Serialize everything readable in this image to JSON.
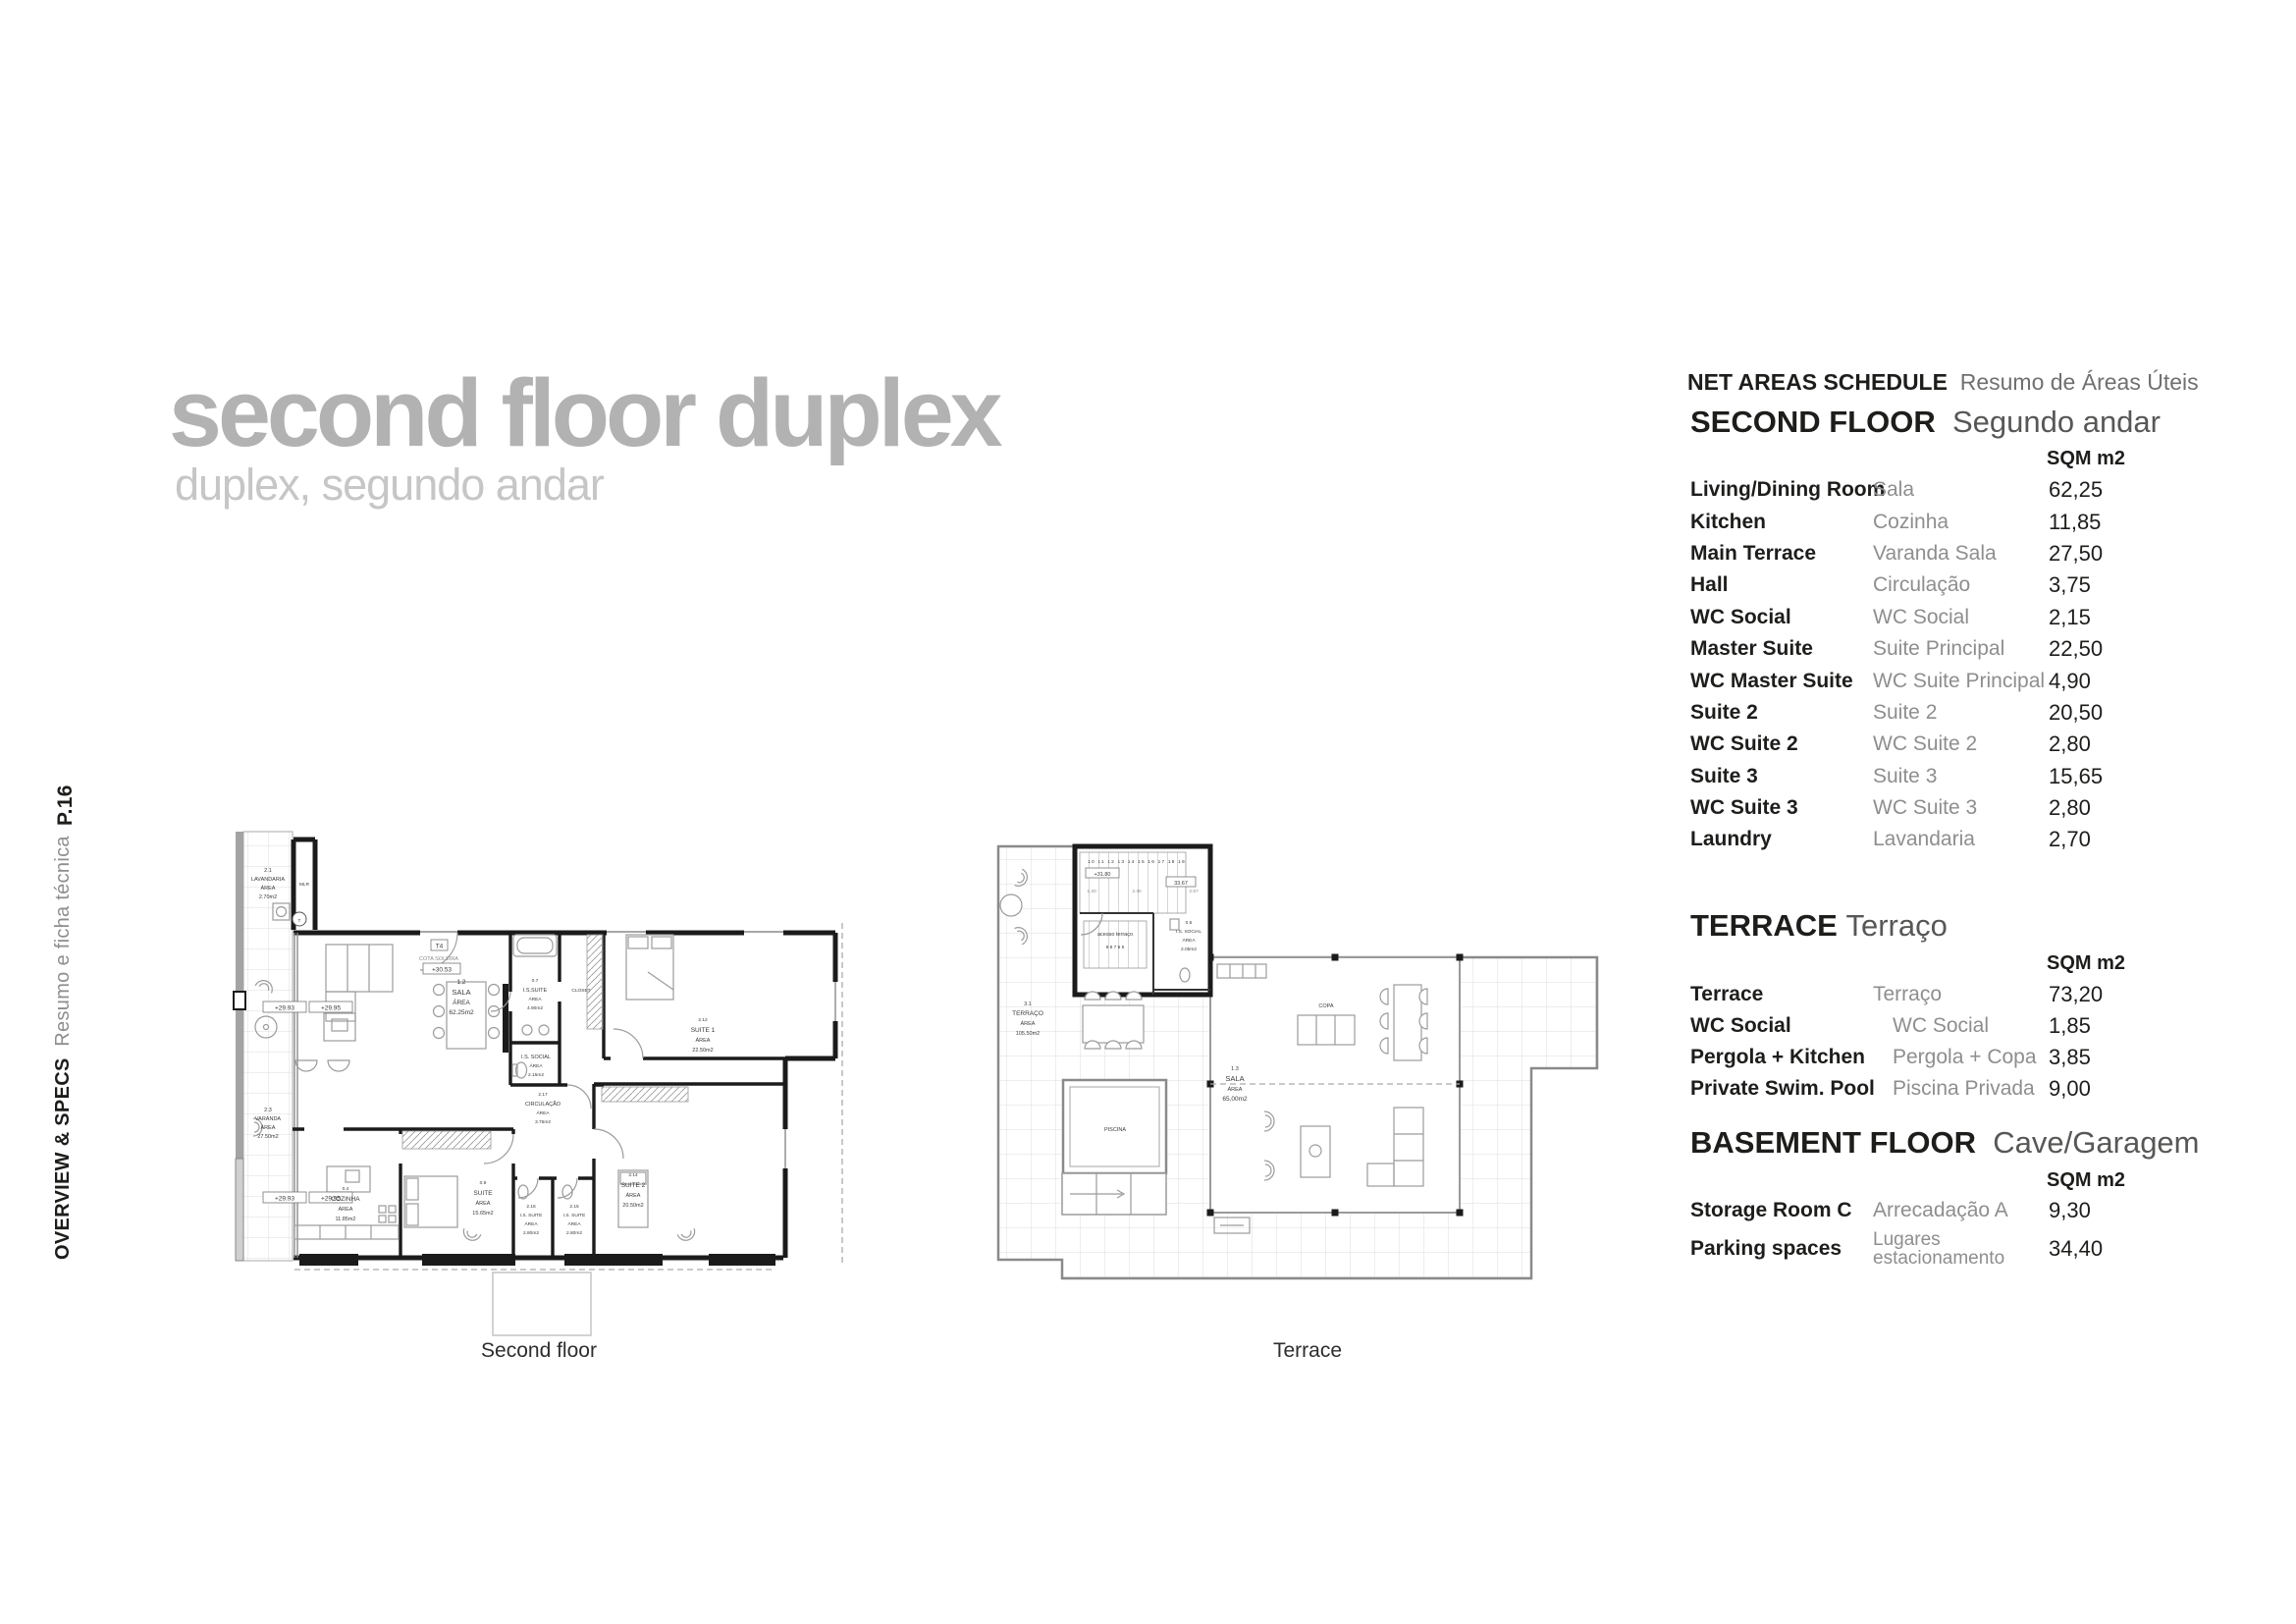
{
  "page": {
    "number": "P.16",
    "section_en": "OVERVIEW & SPECS",
    "section_pt": "Resumo e ficha técnica"
  },
  "title": {
    "en": "second floor duplex",
    "pt": "duplex, segundo andar"
  },
  "schedule": {
    "header_en": "NET AREAS SCHEDULE",
    "header_pt": "Resumo de Áreas Úteis",
    "unit_label": "SQM m2",
    "sections": [
      {
        "title_en": "SECOND FLOOR",
        "title_pt": "Segundo andar",
        "rows": [
          {
            "en": "Living/Dining Room",
            "pt": "Sala",
            "sqm": "62,25"
          },
          {
            "en": "Kitchen",
            "pt": "Cozinha",
            "sqm": "11,85"
          },
          {
            "en": "Main Terrace",
            "pt": "Varanda Sala",
            "sqm": "27,50"
          },
          {
            "en": "Hall",
            "pt": "Circulação",
            "sqm": "3,75"
          },
          {
            "en": "WC Social",
            "pt": "WC Social",
            "sqm": "2,15"
          },
          {
            "en": "Master Suite",
            "pt": "Suite Principal",
            "sqm": "22,50"
          },
          {
            "en": "WC Master Suite",
            "pt": "WC Suite Principal",
            "sqm": "4,90"
          },
          {
            "en": "Suite 2",
            "pt": "Suite 2",
            "sqm": "20,50"
          },
          {
            "en": "WC Suite 2",
            "pt": "WC Suite 2",
            "sqm": "2,80"
          },
          {
            "en": "Suite 3",
            "pt": "Suite 3",
            "sqm": "15,65"
          },
          {
            "en": "WC Suite 3",
            "pt": "WC Suite 3",
            "sqm": "2,80"
          },
          {
            "en": "Laundry",
            "pt": "Lavandaria",
            "sqm": "2,70"
          }
        ]
      },
      {
        "title_en": "TERRACE",
        "title_pt": "Terraço",
        "rows": [
          {
            "en": "Terrace",
            "pt": "Terraço",
            "sqm": "73,20"
          },
          {
            "en": "WC Social",
            "pt": "WC Social",
            "sqm": "1,85"
          },
          {
            "en": "Pergola + Kitchen",
            "pt": "Pergola + Copa",
            "sqm": "3,85"
          },
          {
            "en": "Private Swim. Pool",
            "pt": "Piscina Privada",
            "sqm": "9,00"
          }
        ]
      },
      {
        "title_en": "BASEMENT FLOOR",
        "title_pt": "Cave/Garagem",
        "rows": [
          {
            "en": "Storage Room C",
            "pt": "Arrecadação A",
            "sqm": "9,30"
          },
          {
            "en": "Parking spaces",
            "pt": "Lugares estacionamento",
            "sqm": "34,40"
          }
        ]
      }
    ]
  },
  "plans": {
    "second_floor": {
      "caption": "Second floor",
      "labels": {
        "lavandaria": [
          "2.1",
          "LAVANDARIA",
          "ÁREA",
          "2.70m2"
        ],
        "varanda": [
          "2.3",
          "VARANDA",
          "ÁREA",
          "27.50m2"
        ],
        "mlr": "MLR",
        "t_circle": "T",
        "t4": "T4",
        "cota_soleira": "COTA SOLEIRA",
        "cota_value": "+30.53",
        "level_a": "+29.93",
        "level_b": "+29.95",
        "sala": [
          "1.2",
          "SALA",
          "ÁREA",
          "62.25m2"
        ],
        "is_suite_master": [
          "0.7",
          "I.S.SUITE",
          "ÁREA",
          "4.90m2"
        ],
        "closet": "CLOSET",
        "suite1": [
          "2.12",
          "SUITE 1",
          "ÁREA",
          "22.50m2"
        ],
        "is_social": [
          "I.S. SOCIAL",
          "ÁREA",
          "2.15m2"
        ],
        "circulacao": [
          "2.17",
          "CIRCULAÇÃO",
          "ÁREA",
          "3.75m2"
        ],
        "cozinha": [
          "0.4",
          "COZINHA",
          "ÁREA",
          "11.85m2"
        ],
        "suite": [
          "0.9",
          "SUITE",
          "ÁREA",
          "15.65m2"
        ],
        "is_suite_2": [
          "2.16",
          "I.S. SUITE",
          "ÁREA",
          "2.80m2"
        ],
        "is_suite_3": [
          "2.15",
          "I.S. SUITE",
          "ÁREA",
          "2.80m2"
        ],
        "suite2": [
          "2.14",
          "SUITE 2",
          "ÁREA",
          "20.50m2"
        ]
      }
    },
    "terrace": {
      "caption": "Terrace",
      "labels": {
        "terraco": [
          "3.1",
          "TERRAÇO",
          "ÁREA",
          "105.50m2"
        ],
        "sala": [
          "1.3",
          "SALA",
          "ÁREA",
          "65,00m2"
        ],
        "is_social": [
          "0.5",
          "I.S. SOCIAL",
          "ÁREA",
          "2.05m2"
        ],
        "piscina": "PISCINA",
        "copa": "COPA",
        "acesso": "acesso terraço",
        "level": "+31.80",
        "dim_total": "33.67",
        "treads_upper": "10 11 12 13 14 15 16 17 18 19",
        "treads_lower": "9 8 7 6 5",
        "dims": [
          "1.20",
          "2.40",
          "2.67"
        ]
      }
    }
  }
}
